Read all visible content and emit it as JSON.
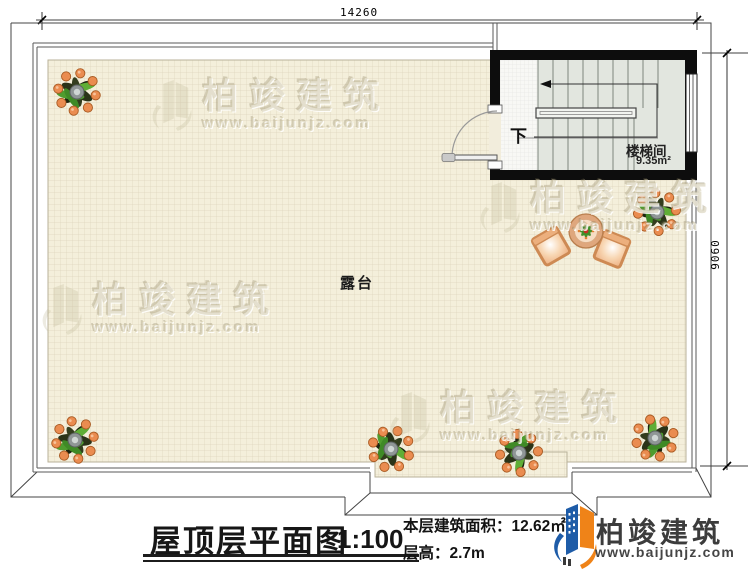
{
  "dimensions": {
    "top_width": "14260",
    "right_height": "9060"
  },
  "plan_labels": {
    "terrace": "露台",
    "stair_room": "楼梯间",
    "stair_room_area": "9.35m²",
    "stair_direction": "下"
  },
  "watermark": {
    "brand": "柏竣建筑",
    "site": "www.baijunjz.com"
  },
  "title_block": {
    "drawing_title": "屋顶层平面图",
    "scale": "1:100",
    "floor_area": "本层建筑面积：12.62㎡",
    "floor_height": "层高：2.7m"
  },
  "brand": {
    "name": "柏竣建筑",
    "site": "www.baijunjz.com"
  },
  "colors": {
    "wall_black": "#0d0d0d",
    "tile_floor": "#f4efdb",
    "tile_grid": "#ded5bd",
    "stair_floor": "#e2e6df",
    "brand_blue": "#1e5ca8",
    "brand_orange": "#ef8318",
    "berry_orange": "#ea8c50",
    "leaf_green": "#4f9c2e"
  }
}
